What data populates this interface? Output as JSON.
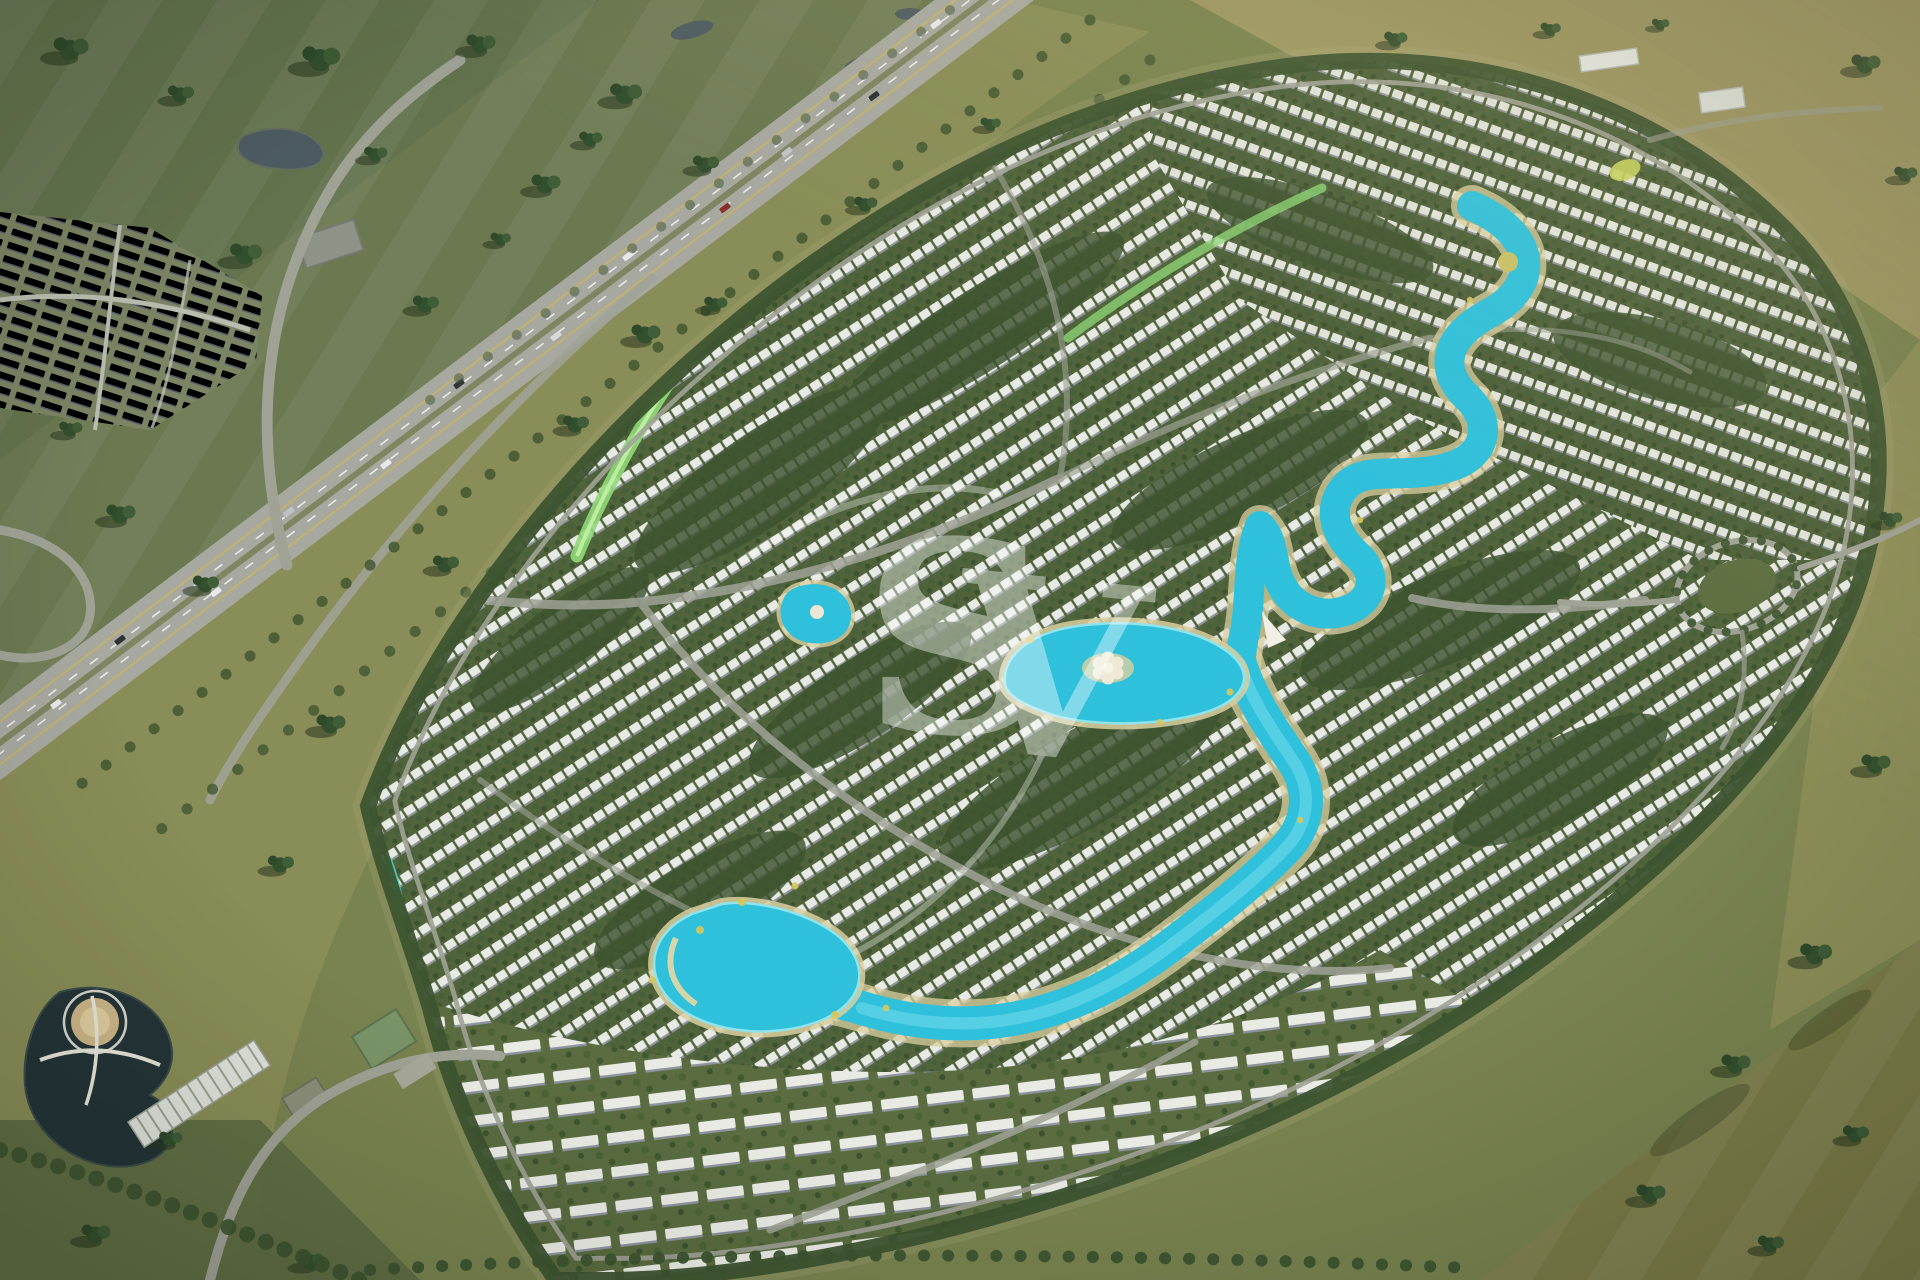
{
  "meta": {
    "title": "Aerial master-plan render",
    "type": "architectural aerial rendering",
    "description": "Bird's-eye render of a large oval master-planned villa community with winding turquoise lagoons, dense white villa rows, tree-lined streets, an amenity lake, surrounded by open fields and a diagonal divided highway with an existing neighborhood to the north-west."
  },
  "watermark": {
    "letters": [
      "S",
      "V"
    ]
  },
  "scene": {
    "landmarks": [
      "divided-highway-with-traffic",
      "existing-neighborhood-grid",
      "small-ponds",
      "oval-villa-development",
      "central-flower-island-lagoon",
      "upper-winding-lagoon",
      "southern-beach-lagoon",
      "linear-green-park",
      "amenity-dark-lake-with-bridges",
      "gold-dome-pavilion",
      "tree-ringed-roundabout",
      "scattered-tree-clusters",
      "open-grass-fields"
    ]
  },
  "colors": {
    "field": "#79834f",
    "fieldnw": "#6b7850",
    "tan": "#9c9662",
    "band": "#8f905a",
    "lagoon": "#2fc0dc",
    "sand": "#d9cfa0",
    "tree": "#3d5430",
    "villa": "#e7e9e4",
    "road": "#a0a296",
    "highway": "#a7a8a0",
    "pond": "#4e5c63",
    "darklake": "#243538",
    "park": "#8fd978",
    "wm": "#ffffff"
  }
}
